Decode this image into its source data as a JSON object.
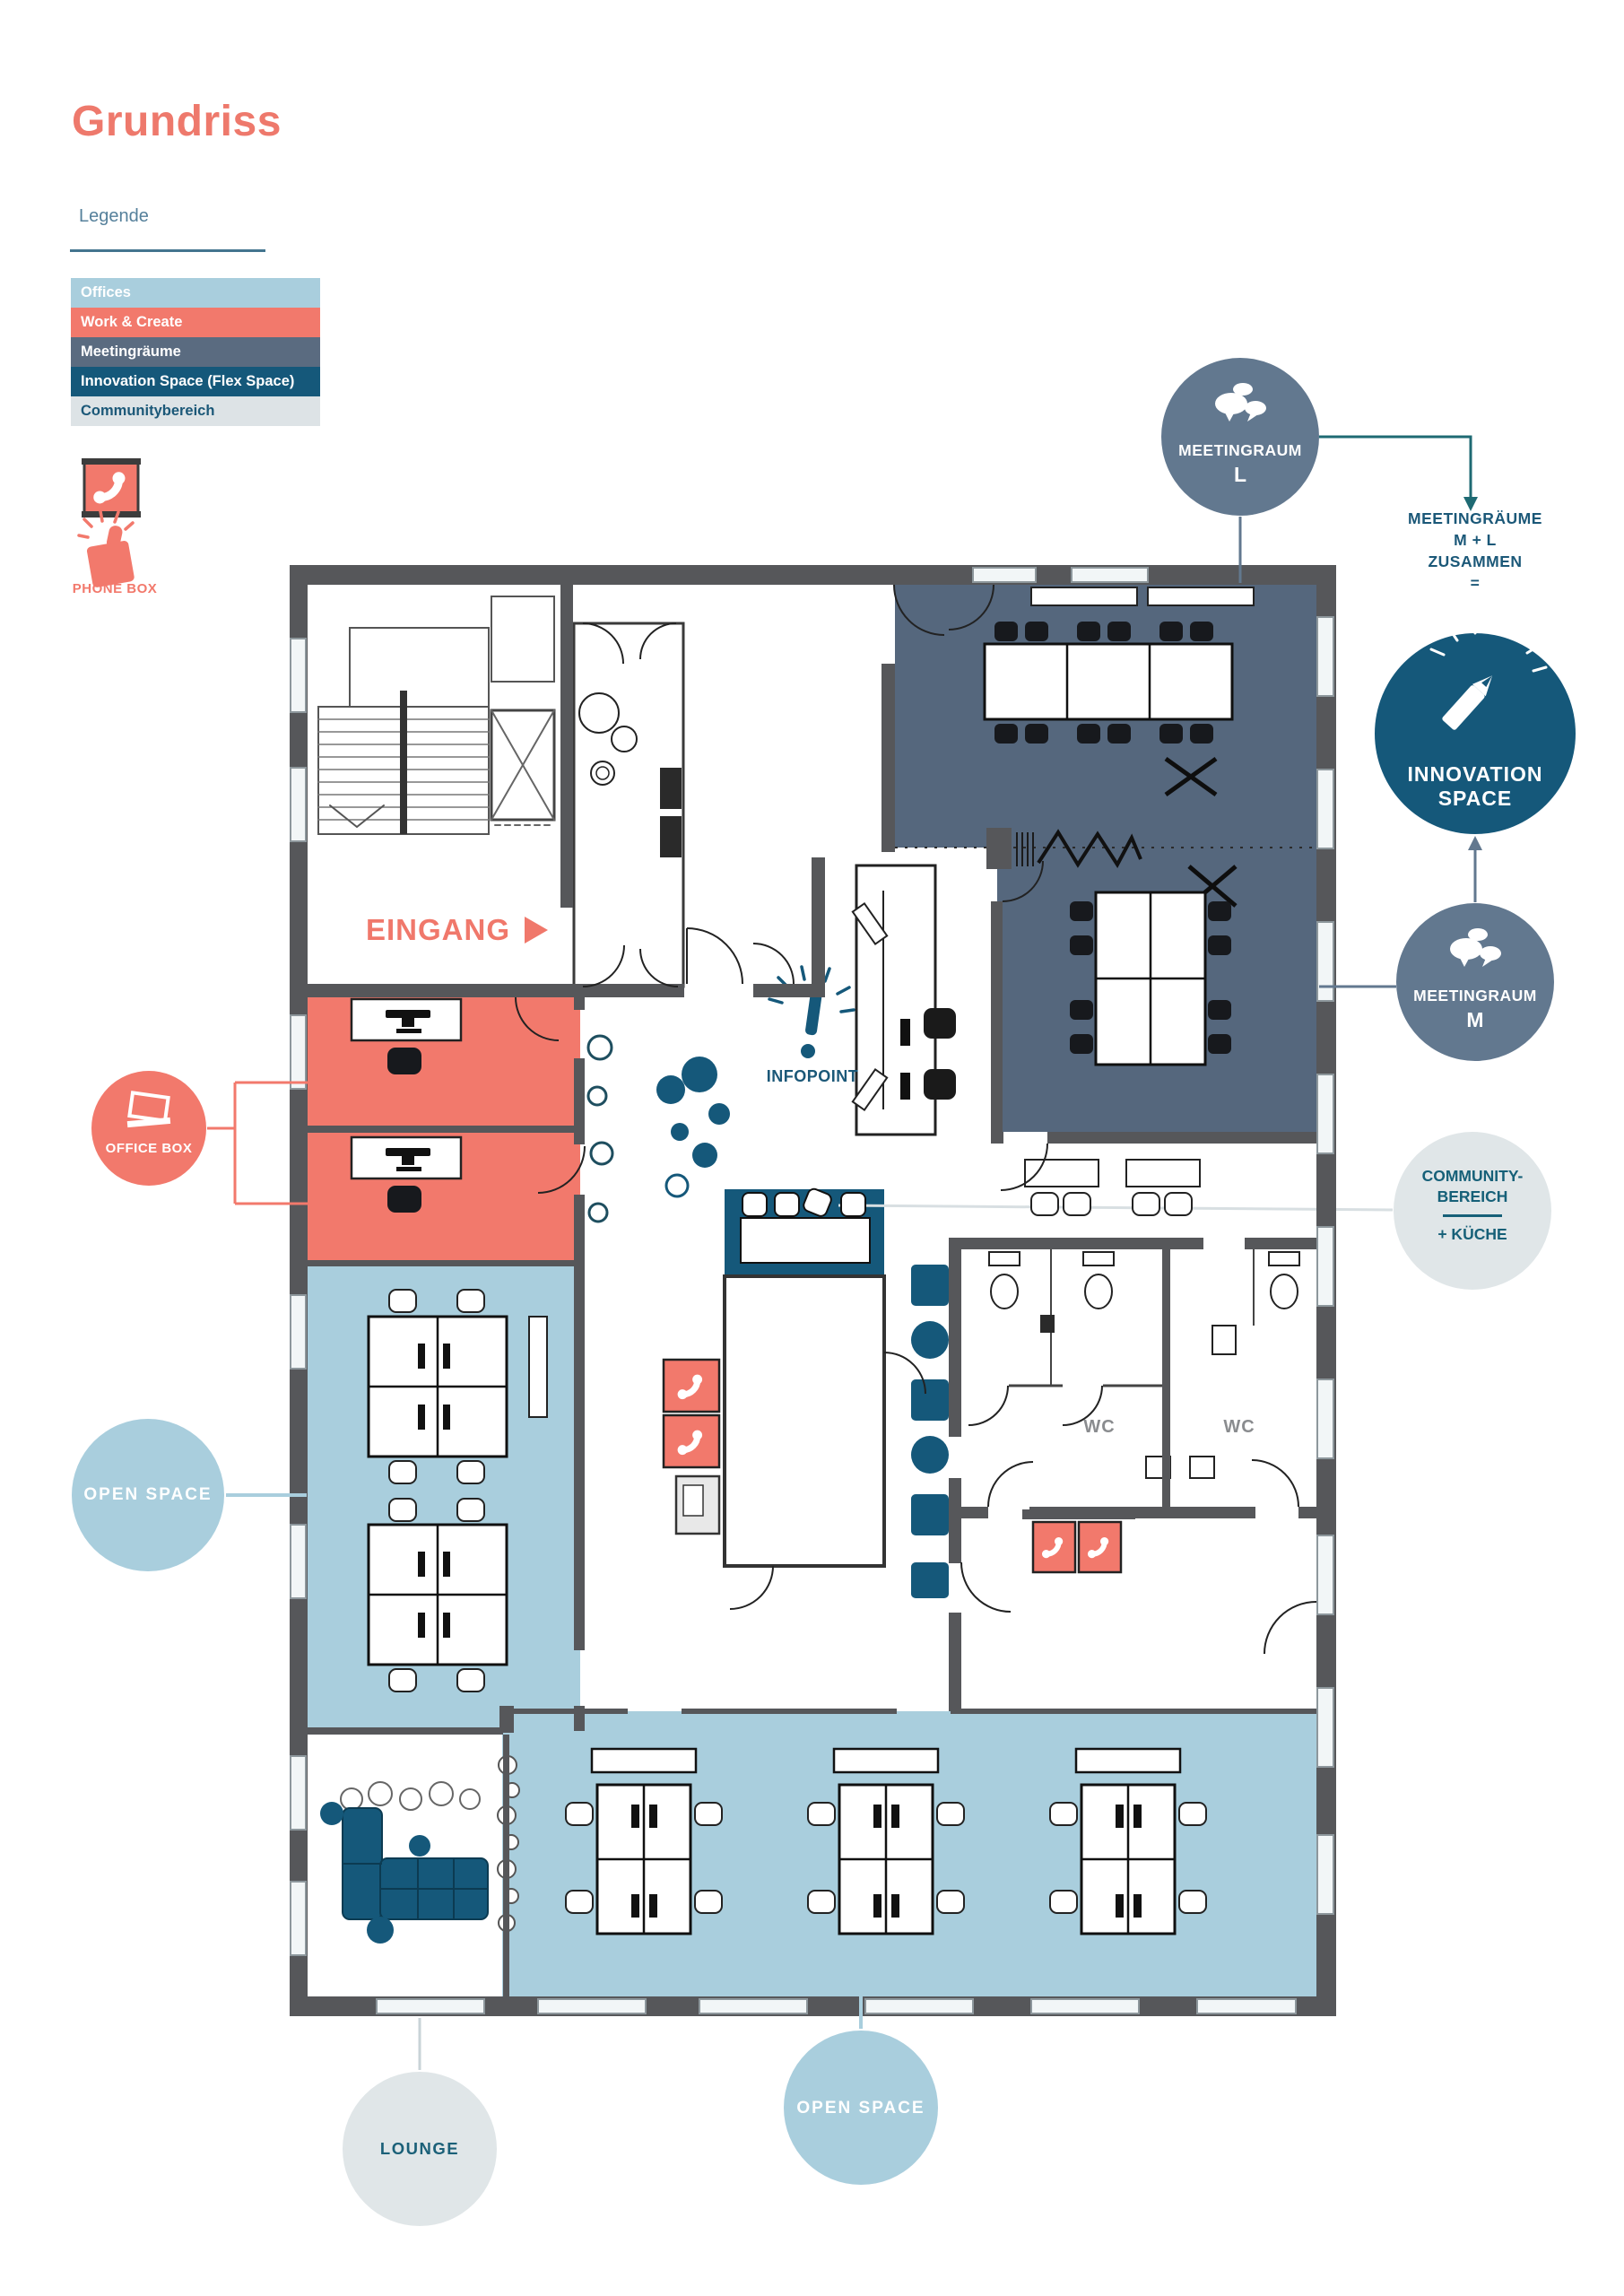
{
  "page": {
    "title": "Grundriss"
  },
  "legend": {
    "heading": "Legende",
    "items": [
      {
        "label": "Offices",
        "color": "#a9cedd",
        "text_color": "#ffffff"
      },
      {
        "label": "Work & Create",
        "color": "#f2796c",
        "text_color": "#ffffff"
      },
      {
        "label": "Meetingräume",
        "color": "#5a6b80",
        "text_color": "#ffffff"
      },
      {
        "label": "Innovation Space (Flex Space)",
        "color": "#15587a",
        "text_color": "#ffffff"
      },
      {
        "label": "Communitybereich",
        "color": "#dde3e6",
        "text_color": "#1b5878"
      }
    ],
    "phone_box": {
      "label": "PHONE BOX"
    }
  },
  "plan": {
    "entrance_label": "EINGANG",
    "infopoint_label": "INFOPOINT",
    "wc_left_label": "WC",
    "wc_right_label": "WC"
  },
  "callouts": {
    "meetingraum_l": {
      "title": "MEETINGRAUM",
      "letter": "L"
    },
    "meeting_combo": {
      "line1": "MEETINGRÄUME",
      "line2": "M + L",
      "line3": "ZUSAMMEN",
      "line4": "="
    },
    "innovation_space": {
      "line1": "INNOVATION",
      "line2": "SPACE"
    },
    "meetingraum_m": {
      "title": "MEETINGRAUM",
      "letter": "M"
    },
    "community": {
      "line1": "COMMUNITY-",
      "line2": "BEREICH",
      "line3": "+ KÜCHE"
    },
    "office_box": {
      "label": "OFFICE BOX"
    },
    "open_space_left": {
      "label": "OPEN SPACE"
    },
    "lounge": {
      "label": "LOUNGE"
    },
    "open_space_bottom": {
      "label": "OPEN SPACE"
    }
  },
  "colors": {
    "accent_coral": "#f2796c",
    "offices_blue": "#a9cedd",
    "meeting_slate": "#5a6b80",
    "meeting_room_fill": "#55677d",
    "innovation_teal": "#15587a",
    "community_gray": "#dde3e6",
    "wall_gray": "#56575a",
    "label_teal": "#1b5878",
    "connector_teal": "#1e6a73"
  }
}
